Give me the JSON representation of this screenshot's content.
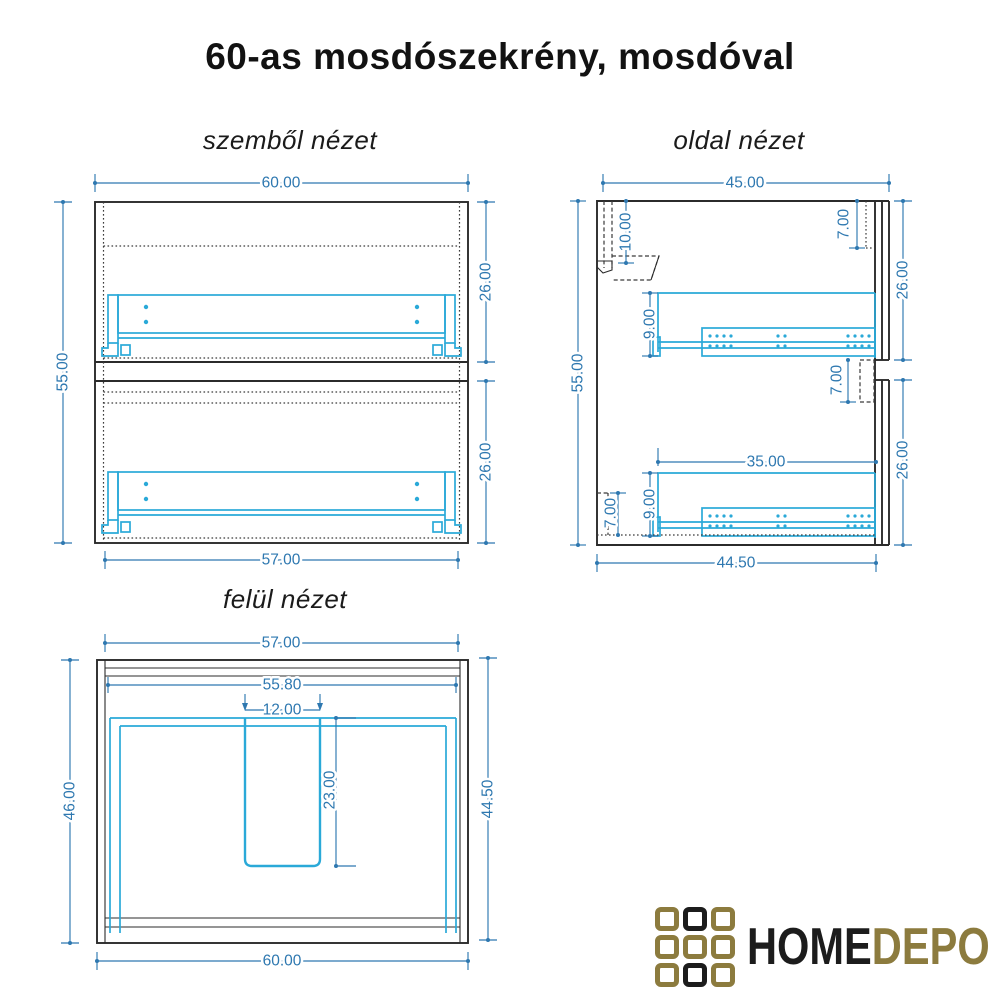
{
  "title": "60-as mosdószekrény, mosdóval",
  "colors": {
    "background": "#ffffff",
    "outline": "#2b2b2b",
    "drawer": "#2aa9d8",
    "dimension": "#2e78b0",
    "logo_gold": "#8c7b3e",
    "logo_black": "#1c1c1c"
  },
  "views": {
    "front": {
      "label": "szemből nézet",
      "dims": {
        "width_top": "60.00",
        "height_left": "55.00",
        "drawer_upper_height": "26.00",
        "drawer_lower_height": "26.00",
        "width_bottom": "57.00"
      }
    },
    "side": {
      "label": "oldal nézet",
      "dims": {
        "depth_top": "45.00",
        "height_left": "55.00",
        "bracket_drop": "10.00",
        "top_recess": "7.00",
        "drawer_upper_height": "26.00",
        "rail_upper_height": "9.00",
        "mid_recess": "7.00",
        "rail_length": "35.00",
        "rail_lower_height": "9.00",
        "plinth_height": "7.00",
        "drawer_lower_height": "26.00",
        "depth_bottom": "44.50"
      }
    },
    "top": {
      "label": "felül nézet",
      "dims": {
        "width_top": "57.00",
        "inner_width": "55.80",
        "cutout_width": "12.00",
        "cutout_depth": "23.00",
        "depth_left": "46.00",
        "depth_right": "44.50",
        "width_bottom": "60.00"
      }
    }
  },
  "logo": {
    "home": "HOME",
    "depo": "DEPO",
    "grid": [
      [
        "gold",
        "black",
        "gold"
      ],
      [
        "gold",
        "gold",
        "gold"
      ],
      [
        "gold",
        "black",
        "gold"
      ]
    ]
  }
}
